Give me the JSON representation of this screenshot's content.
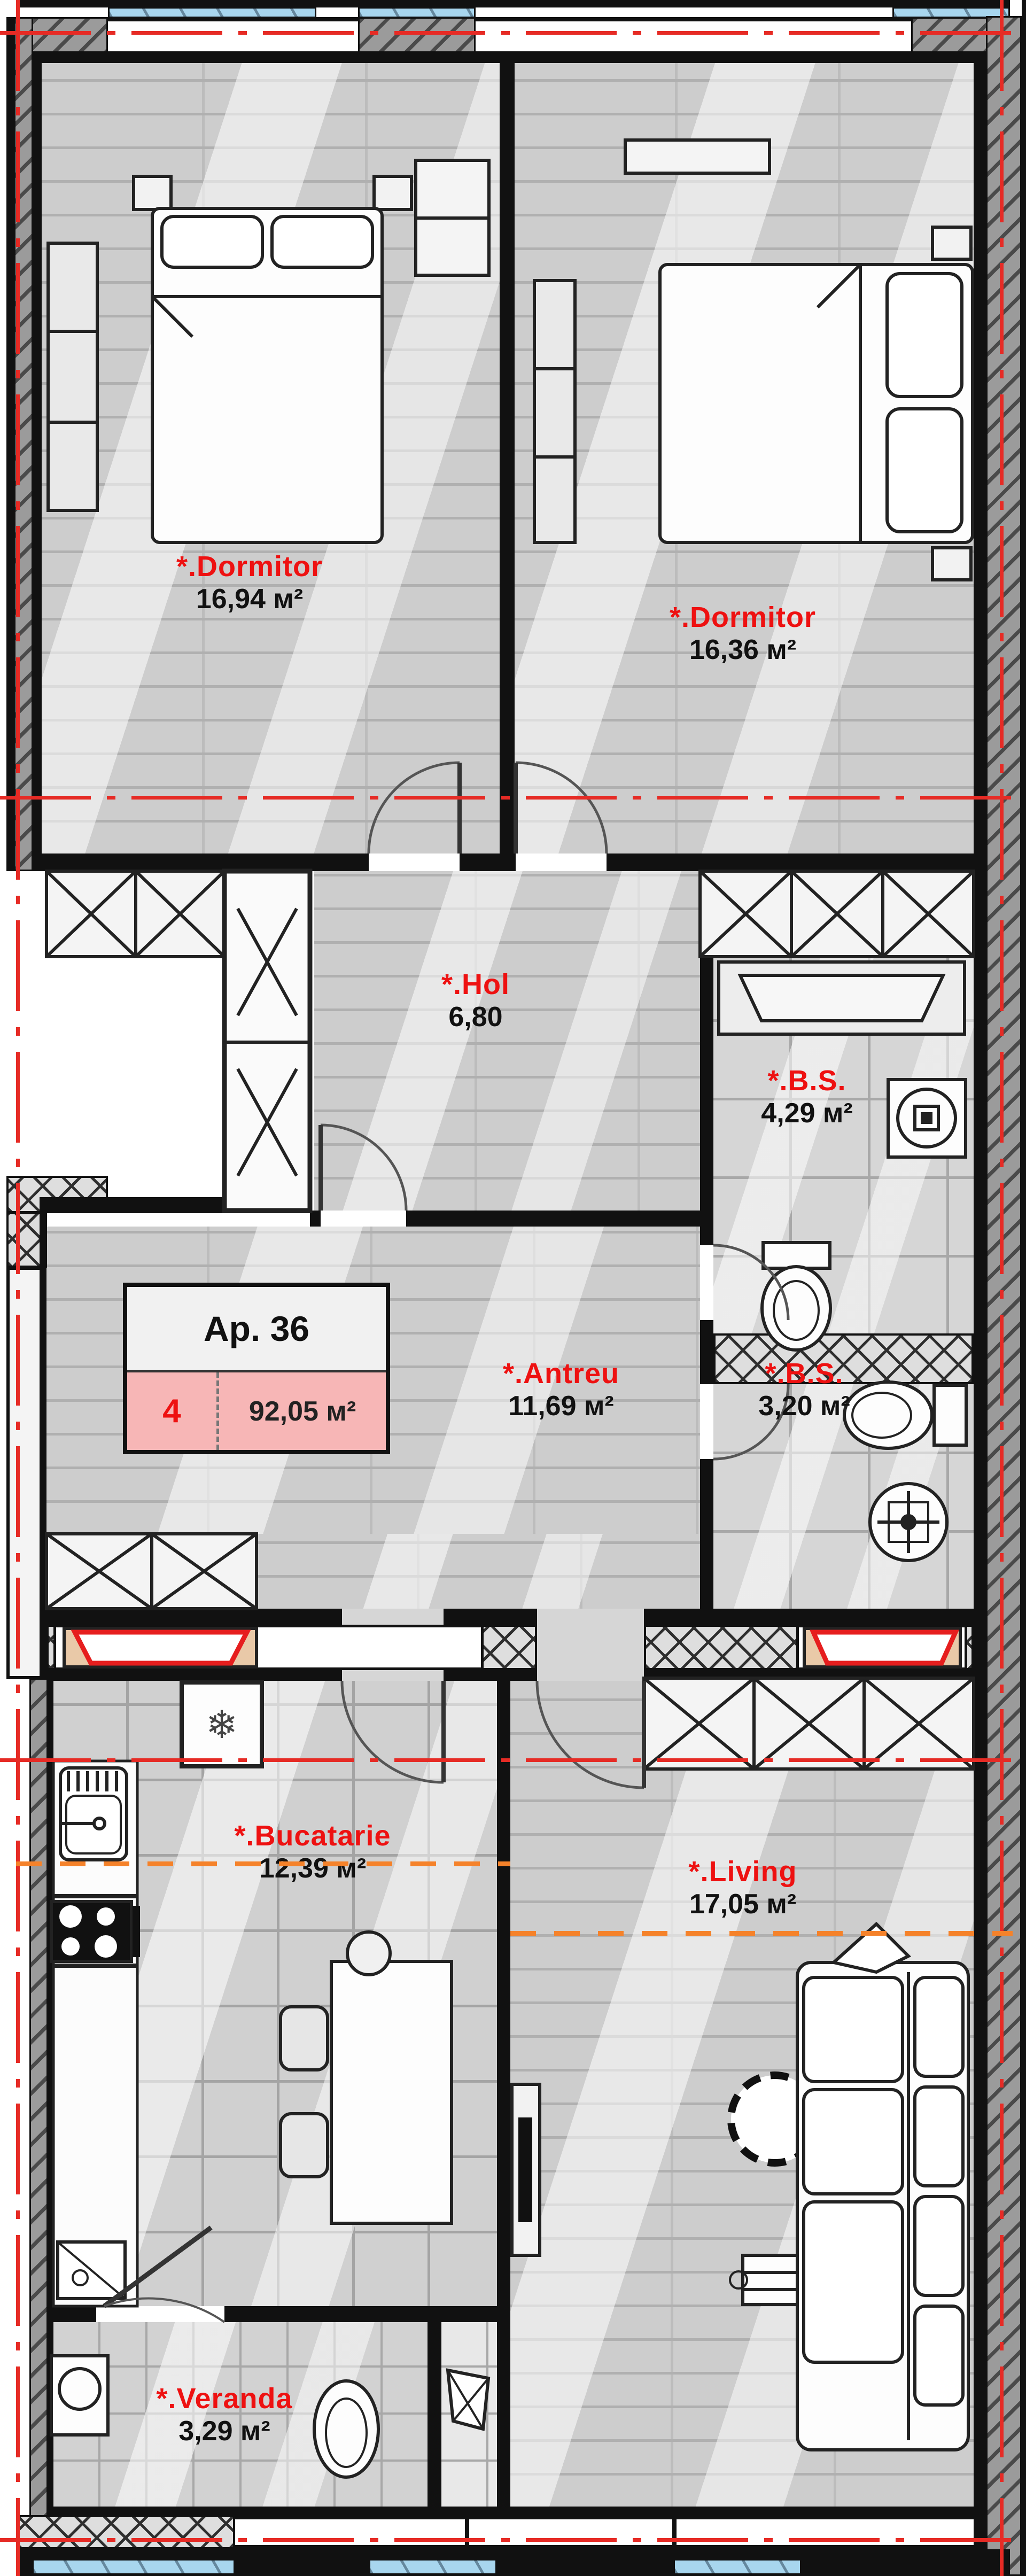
{
  "plan": {
    "apartment_card": {
      "title": "Ap. 36",
      "number": "4",
      "total_area": "92,05 м²"
    },
    "rooms": {
      "dormitor1": {
        "name": "*.Dormitor",
        "area": "16,94 м²"
      },
      "dormitor2": {
        "name": "*.Dormitor",
        "area": "16,36 м²"
      },
      "hol": {
        "name": "*.Hol",
        "area": "6,80"
      },
      "bs1": {
        "name": "*.B.S.",
        "area": "4,29 м²"
      },
      "antreu": {
        "name": "*.Antreu",
        "area": "11,69 м²"
      },
      "bs2": {
        "name": "*.B.S.",
        "area": "3,20 м²"
      },
      "bucatarie": {
        "name": "*.Bucatarie",
        "area": "12,39 м²"
      },
      "living": {
        "name": "*.Living",
        "area": "17,05 м²"
      },
      "veranda": {
        "name": "*.Veranda",
        "area": "3,29 м²"
      }
    },
    "icons": {
      "fridge_snowflake": "❄"
    },
    "colors": {
      "label_red": "#ee1111",
      "section_line_red": "#e62b25",
      "section_line_orange": "#f5822a",
      "glazing_blue": "#a8d6ee",
      "card_pink": "#f7b6b6",
      "wall_black": "#111111"
    }
  }
}
